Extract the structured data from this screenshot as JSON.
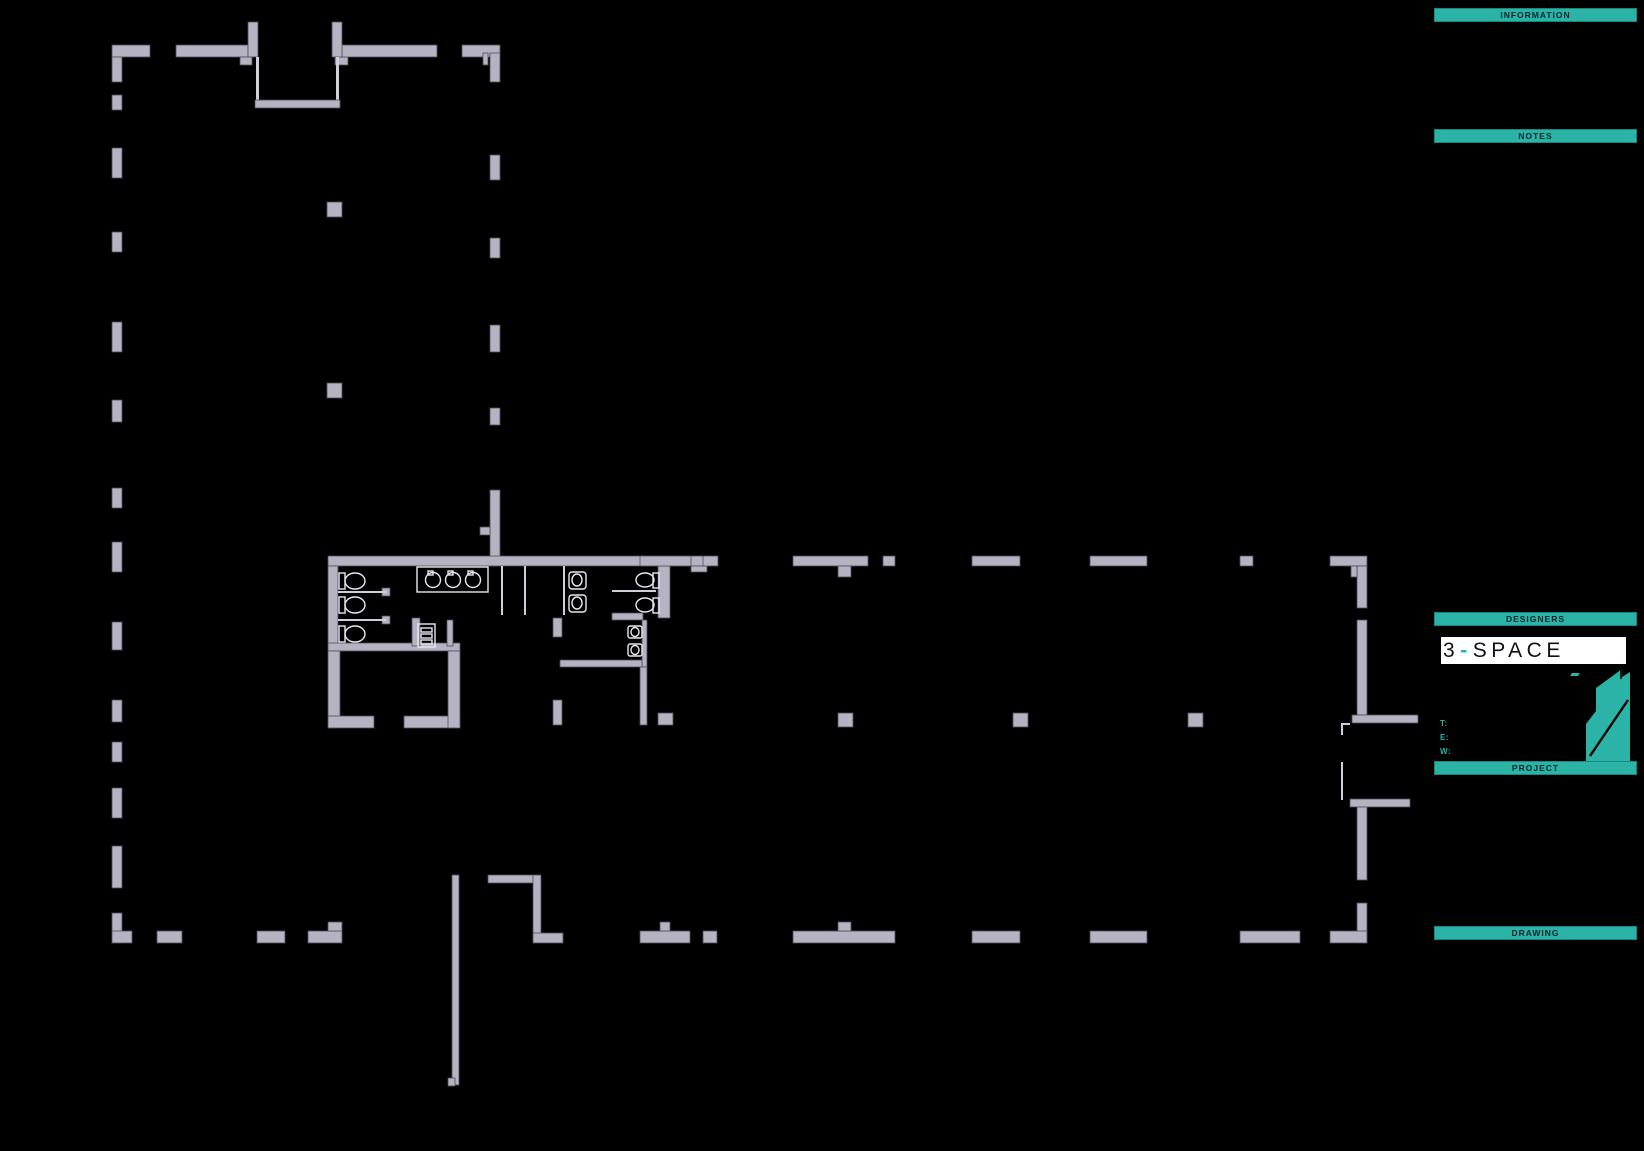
{
  "sheet": {
    "background": "#000000",
    "description": "architectural ground floor plan drawing sheet"
  },
  "palette": {
    "accent_teal": "#2ab3a6",
    "header_text": "#062529",
    "wall_fill": "#b5b3c2",
    "wall_edge": "#504d5a",
    "fixture_line": "#e8e8f0",
    "logo_background": "#ffffff",
    "logo_text": "#101016"
  },
  "title_block": {
    "information_label": "INFORMATION",
    "notes_label": "NOTES",
    "designers_label": "DESIGNERS",
    "project_label": "PROJECT",
    "drawing_label": "DRAWING",
    "logo": {
      "parts": [
        "3",
        "-",
        "SPACE"
      ]
    },
    "contacts": [
      {
        "label": "T:"
      },
      {
        "label": "E:"
      },
      {
        "label": "W:"
      }
    ]
  }
}
